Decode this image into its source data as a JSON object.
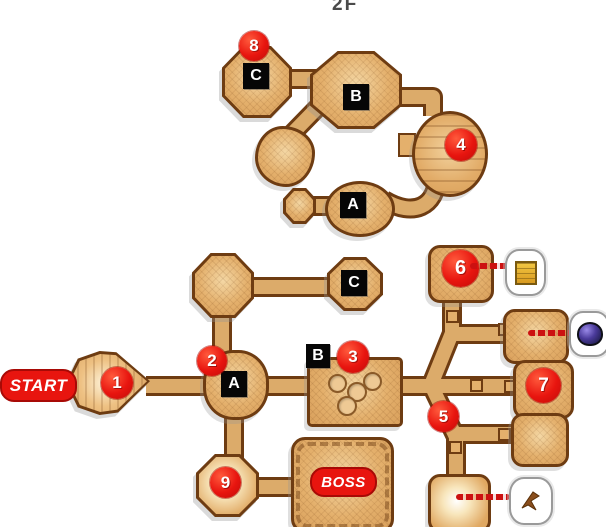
{
  "floor_label": "2F",
  "start": {
    "label": "START"
  },
  "boss": {
    "label": "BOSS"
  },
  "badges": {
    "b1": "1",
    "b2": "2",
    "b3": "3",
    "b4": "4",
    "b5": "5",
    "b6": "6",
    "b7": "7",
    "b8": "8",
    "b9": "9"
  },
  "stairs_upper": {
    "a": "A",
    "b": "B",
    "c": "C"
  },
  "stairs_lower": {
    "a": "A",
    "b": "B",
    "c": "C"
  },
  "items": {
    "map": {
      "icon": "map-scroll-icon"
    },
    "gem": {
      "icon": "gem-icon"
    },
    "hook": {
      "icon": "boomerang-icon"
    }
  },
  "colors": {
    "background": "#ffffff",
    "room_fill": "#e0ab68",
    "room_fill_light": "#f4d7a4",
    "room_border": "#6e3c12",
    "corridor_fill": "#dcab6a",
    "badge_red": "#e8150f",
    "stair_black": "#060606",
    "arrow_red": "#cc1111",
    "floor_label_gray": "#4a4a4a"
  }
}
